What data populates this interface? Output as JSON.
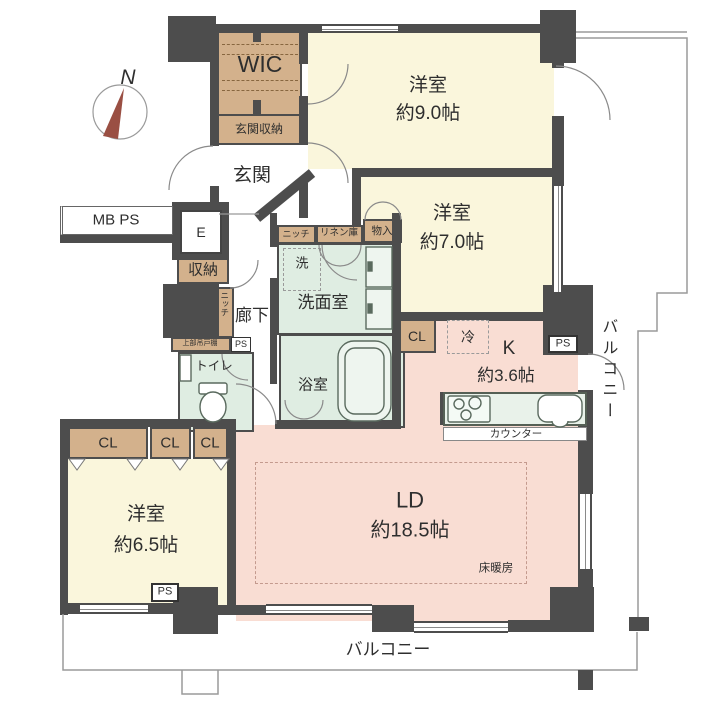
{
  "plan": {
    "compass_n": "N",
    "rooms": {
      "wic": {
        "label": "WIC"
      },
      "entrance_storage": {
        "label": "玄関収納"
      },
      "entrance": {
        "label": "玄関"
      },
      "bedroom_9": {
        "label": "洋室",
        "size": "約9.0帖"
      },
      "bedroom_7": {
        "label": "洋室",
        "size": "約7.0帖"
      },
      "bedroom_65": {
        "label": "洋室",
        "size": "約6.5帖"
      },
      "living_dining": {
        "label": "LD",
        "size": "約18.5帖",
        "floor_heating": "床暖房"
      },
      "kitchen": {
        "label": "K",
        "size": "約3.6帖",
        "counter": "カウンター",
        "fridge": "冷"
      },
      "washroom": {
        "label": "洗面室",
        "washer": "洗"
      },
      "bathroom": {
        "label": "浴室"
      },
      "toilet": {
        "label": "トイレ"
      },
      "hallway": {
        "label": "廊下"
      }
    },
    "storage": {
      "closet": "CL",
      "hall_storage": "収納",
      "niche": "ニッチ",
      "upper_cabinet": "上部吊戸棚",
      "linen": "リネン庫",
      "storage_small": "物入"
    },
    "utility": {
      "meter_box": "MB PS",
      "elevator": "E",
      "pipe_space": "PS"
    },
    "balcony": "バルコニー",
    "colors": {
      "wall": "#4d4d4d",
      "bedroom": "#faf6dc",
      "living": "#f9ddd3",
      "closet": "#d3b18c",
      "wet": "#dfede2",
      "fixture": "#e9f2ea",
      "balcony-line": "#9a9a9a",
      "needle": "#9a4f43"
    }
  }
}
